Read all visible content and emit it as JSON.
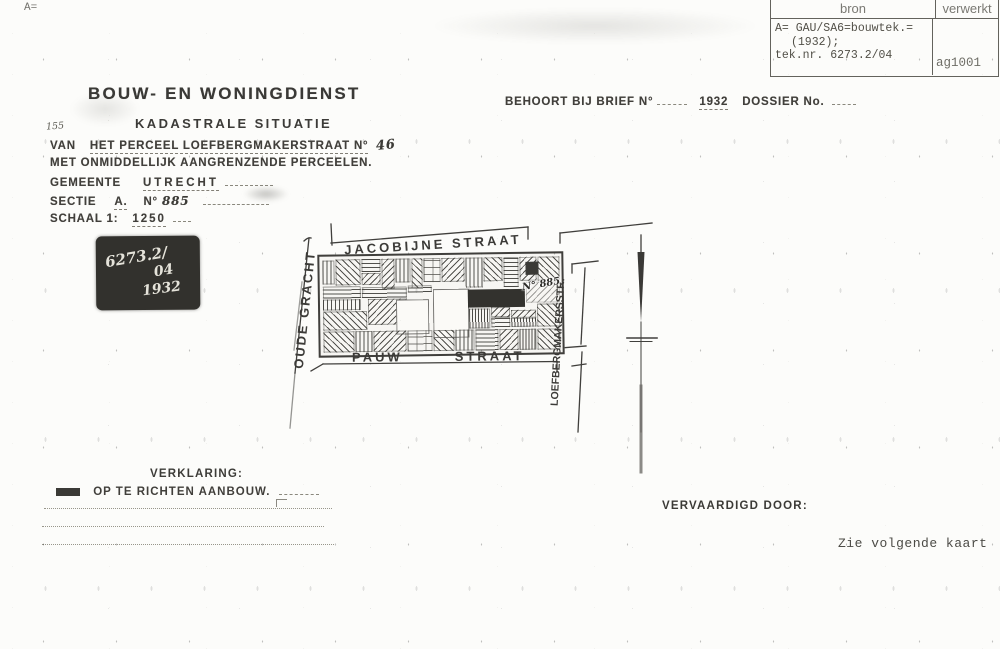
{
  "scan": {
    "corner_mark": "A=",
    "register_table": {
      "headers": {
        "bron": "bron",
        "verwerkt": "verwerkt"
      },
      "bron_line1": "A= GAU/SA6=bouwtek.=",
      "bron_line2": "(1932);",
      "bron_line3": "tek.nr. 6273.2/04",
      "verwerkt_value": "ag1001"
    },
    "next_note": "Zie volgende kaart"
  },
  "document": {
    "service_title": "BOUW- EN WONINGDIENST",
    "doc_type": "KADASTRALE SITUATIE",
    "margin_note": "155",
    "behoort": {
      "label": "BEHOORT BIJ BRIEF N°",
      "year": "1932",
      "dossier_label": "DOSSIER No."
    },
    "form": {
      "van_label": "VAN",
      "van_value": "HET PERCEEL LOEFBERGMAKERSTRAAT N°",
      "van_number": "46",
      "adjacent_line": "MET ONMIDDELLIJK AANGRENZENDE PERCEELEN.",
      "gemeente_label": "GEMEENTE",
      "gemeente_value": "UTRECHT",
      "sectie_label": "SECTIE",
      "sectie_value": "A.",
      "sectie_no_label": "N°",
      "sectie_no_value": "885",
      "schaal_label": "SCHAAL 1:",
      "schaal_value": "1250"
    },
    "stamp": {
      "line1": "6273.2/",
      "line2": "04",
      "line3": "1932"
    },
    "legend": {
      "heading": "VERKLARING:",
      "item1": "OP TE RICHTEN AANBOUW."
    },
    "vervaardigd_label": "VERVAARDIGD DOOR:"
  },
  "map": {
    "street_top": "JACOBIJNE STRAAT",
    "street_left": "OUDE GRACHT",
    "street_bottom_word1": "PAUW",
    "street_bottom_word2": "STRAAT",
    "street_right": "LOEFBERGMAKERSSTR.",
    "parcel_annotation": "N° 885"
  },
  "colors": {
    "paper": "#fcfcfa",
    "ink": "#3d3c39",
    "typed_gray": "#55544f",
    "stamp_bg": "#32312d",
    "new_building_black": "#33322e"
  }
}
